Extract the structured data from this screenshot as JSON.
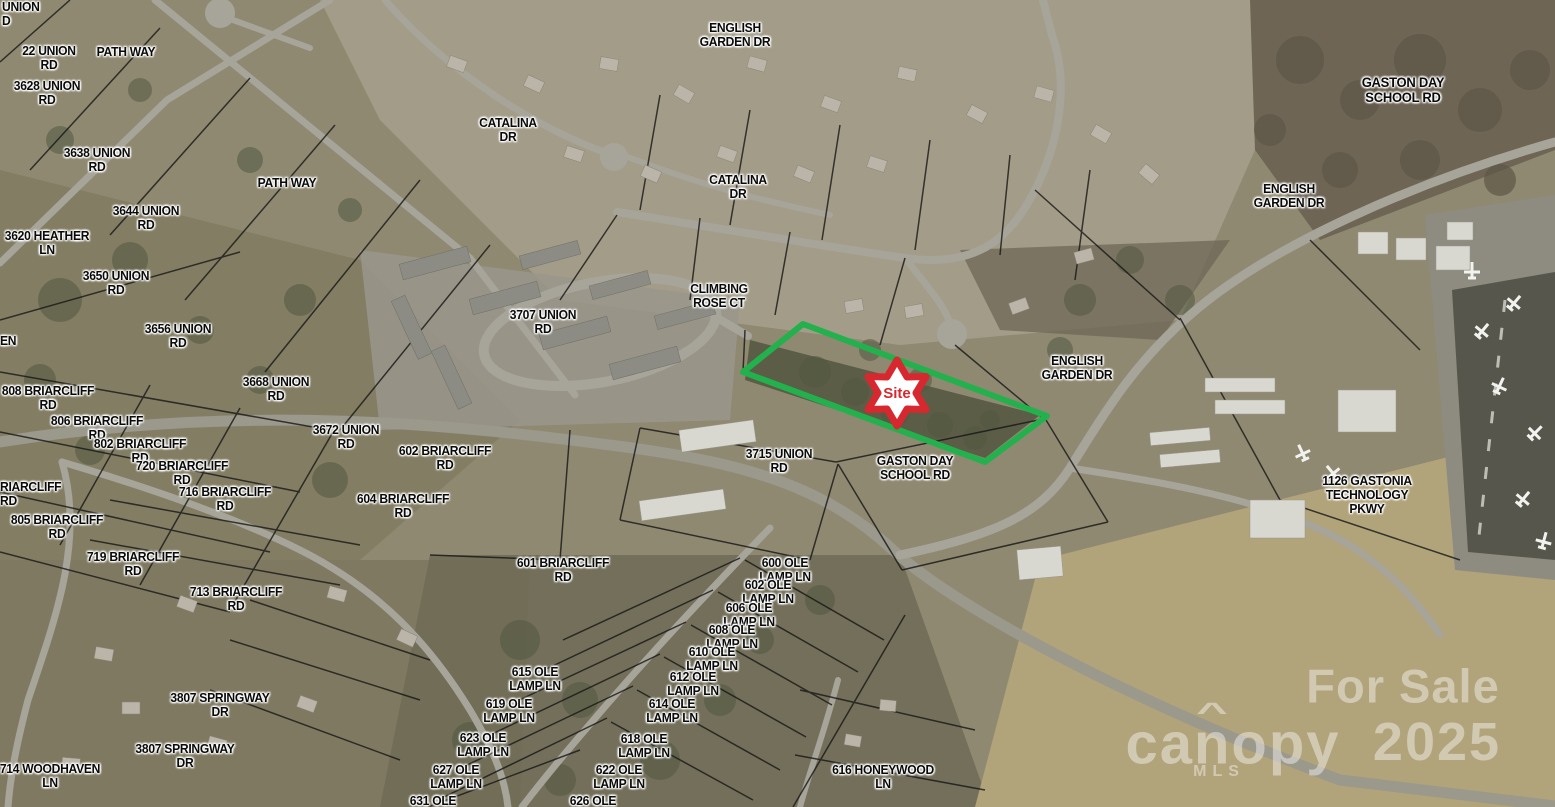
{
  "map": {
    "site": {
      "label": "Site",
      "marker_color": "#d7282f",
      "marker_fill": "#ffffff",
      "outline_color": "#22b14c"
    },
    "watermark": {
      "for_sale": "For Sale",
      "brand": "canopy",
      "brand_sub": "MLS",
      "year": "2025"
    },
    "labels": [
      {
        "t": "UNION\nD",
        "x": 2,
        "y": 14,
        "a": "l"
      },
      {
        "t": "22 UNION\nRD",
        "x": 49,
        "y": 58
      },
      {
        "t": "PATH WAY",
        "x": 126,
        "y": 52
      },
      {
        "t": "3628 UNION\nRD",
        "x": 47,
        "y": 93
      },
      {
        "t": "3638 UNION\nRD",
        "x": 97,
        "y": 160
      },
      {
        "t": "3644 UNION\nRD",
        "x": 146,
        "y": 218
      },
      {
        "t": "3620 HEATHER\nLN",
        "x": 47,
        "y": 243
      },
      {
        "t": "PATH WAY",
        "x": 287,
        "y": 183
      },
      {
        "t": "3650 UNION\nRD",
        "x": 116,
        "y": 283
      },
      {
        "t": "3656 UNION\nRD",
        "x": 178,
        "y": 336
      },
      {
        "t": "EN",
        "x": 0,
        "y": 341,
        "a": "l"
      },
      {
        "t": "3668 UNION\nRD",
        "x": 276,
        "y": 389
      },
      {
        "t": "808 BRIARCLIFF\nRD",
        "x": 48,
        "y": 398
      },
      {
        "t": "806 BRIARCLIFF\nRD",
        "x": 97,
        "y": 428
      },
      {
        "t": "802 BRIARCLIFF\nRD",
        "x": 140,
        "y": 451
      },
      {
        "t": "720 BRIARCLIFF\nRD",
        "x": 182,
        "y": 473
      },
      {
        "t": "716 BRIARCLIFF\nRD",
        "x": 225,
        "y": 499
      },
      {
        "t": "RIARCLIFF\nRD",
        "x": 0,
        "y": 494,
        "a": "l"
      },
      {
        "t": "805 BRIARCLIFF\nRD",
        "x": 57,
        "y": 527
      },
      {
        "t": "719 BRIARCLIFF\nRD",
        "x": 133,
        "y": 564
      },
      {
        "t": "713 BRIARCLIFF\nRD",
        "x": 236,
        "y": 599
      },
      {
        "t": "714 WOODHAVEN\nLN",
        "x": 50,
        "y": 776
      },
      {
        "t": "3807 SPRINGWAY\nDR",
        "x": 220,
        "y": 705
      },
      {
        "t": "3807 SPRINGWAY\nDR",
        "x": 185,
        "y": 756
      },
      {
        "t": "3672 UNION\nRD",
        "x": 346,
        "y": 437
      },
      {
        "t": "602 BRIARCLIFF\nRD",
        "x": 445,
        "y": 458
      },
      {
        "t": "604 BRIARCLIFF\nRD",
        "x": 403,
        "y": 506
      },
      {
        "t": "601 BRIARCLIFF\nRD",
        "x": 563,
        "y": 570
      },
      {
        "t": "ENGLISH\nGARDEN DR",
        "x": 735,
        "y": 35
      },
      {
        "t": "CATALINA\nDR",
        "x": 508,
        "y": 130
      },
      {
        "t": "CATALINA\nDR",
        "x": 738,
        "y": 187
      },
      {
        "t": "CLIMBING\nROSE CT",
        "x": 719,
        "y": 296
      },
      {
        "t": "3707 UNION\nRD",
        "x": 543,
        "y": 322
      },
      {
        "t": "ENGLISH\nGARDEN DR",
        "x": 1077,
        "y": 368
      },
      {
        "t": "3715 UNION\nRD",
        "x": 779,
        "y": 461
      },
      {
        "t": "GASTON DAY\nSCHOOL RD",
        "x": 915,
        "y": 468
      },
      {
        "t": "GASTON DAY\nSCHOOL RD",
        "x": 1403,
        "y": 90,
        "s": 14
      },
      {
        "t": "ENGLISH\nGARDEN DR",
        "x": 1289,
        "y": 196
      },
      {
        "t": "1126 GASTONIA\nTECHNOLOGY\nPKWY",
        "x": 1367,
        "y": 495
      },
      {
        "t": "600 OLE\nLAMP LN",
        "x": 785,
        "y": 570
      },
      {
        "t": "602 OLE\nLAMP LN",
        "x": 768,
        "y": 592
      },
      {
        "t": "606 OLE\nLAMP LN",
        "x": 749,
        "y": 615
      },
      {
        "t": "608 OLE\nLAMP LN",
        "x": 732,
        "y": 637
      },
      {
        "t": "610 OLE\nLAMP LN",
        "x": 712,
        "y": 659
      },
      {
        "t": "612 OLE\nLAMP LN",
        "x": 693,
        "y": 684
      },
      {
        "t": "614 OLE\nLAMP LN",
        "x": 672,
        "y": 711
      },
      {
        "t": "618 OLE\nLAMP LN",
        "x": 644,
        "y": 746
      },
      {
        "t": "622 OLE\nLAMP LN",
        "x": 619,
        "y": 777
      },
      {
        "t": "626 OLE",
        "x": 593,
        "y": 801
      },
      {
        "t": "615 OLE\nLAMP LN",
        "x": 535,
        "y": 679
      },
      {
        "t": "619 OLE\nLAMP LN",
        "x": 509,
        "y": 711
      },
      {
        "t": "623 OLE\nLAMP LN",
        "x": 483,
        "y": 745
      },
      {
        "t": "627 OLE\nLAMP LN",
        "x": 456,
        "y": 777
      },
      {
        "t": "631 OLE",
        "x": 433,
        "y": 801
      },
      {
        "t": "616 HONEYWOOD\nLN",
        "x": 883,
        "y": 777
      }
    ]
  }
}
